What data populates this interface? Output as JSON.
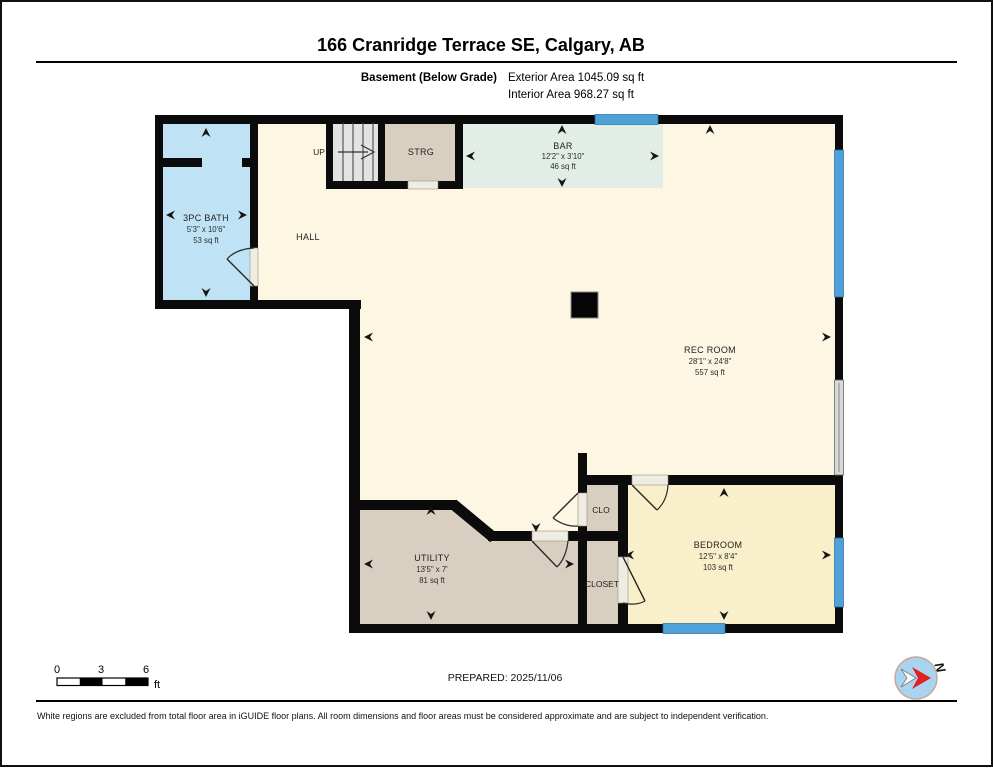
{
  "header": {
    "title": "166 Cranridge Terrace SE, Calgary, AB",
    "floor": "Basement (Below Grade)",
    "exterior_area": "Exterior Area 1045.09 sq ft",
    "interior_area": "Interior Area 968.27 sq ft"
  },
  "plan": {
    "rooms": {
      "bath": {
        "name": "3PC BATH",
        "dims": "5'3\" x 10'6\"",
        "area": "53 sq ft"
      },
      "bar": {
        "name": "BAR",
        "dims": "12'2\" x 3'10\"",
        "area": "46 sq ft"
      },
      "rec_room": {
        "name": "REC ROOM",
        "dims": "28'1\" x 24'8\"",
        "area": "557 sq ft"
      },
      "utility": {
        "name": "UTILITY",
        "dims": "13'5\" x 7'",
        "area": "81 sq ft"
      },
      "bedroom": {
        "name": "BEDROOM",
        "dims": "12'5\" x 8'4\"",
        "area": "103 sq ft"
      },
      "hall": {
        "name": "HALL"
      },
      "strg": {
        "name": "STRG"
      },
      "clo": {
        "name": "CLO"
      },
      "closet": {
        "name": "CLOSET"
      }
    },
    "stairs": {
      "label": "UP"
    },
    "compass": {
      "north_label": "N"
    }
  },
  "footer": {
    "scale": {
      "t0": "0",
      "t3": "3",
      "t6": "6",
      "unit": "ft"
    },
    "prepared": "PREPARED: 2025/11/06",
    "disclaimer": "White regions are excluded from total floor area in iGUIDE floor plans. All room dimensions and floor areas must be considered approximate and are subject to independent verification."
  },
  "colors": {
    "wall": "#0b0b0b",
    "window": "#4fa2d9",
    "floor_cream": "#fcf6e2",
    "bath": "#bfe3f5",
    "bar": "#e2ede6",
    "tan": "#d9cfc0",
    "bedroom": "#f9f0cb",
    "stairs": "#e3e3e3",
    "gray_panel": "#d9d9d9",
    "compass_fill": "#a9d3ee",
    "compass_red": "#e02020"
  }
}
